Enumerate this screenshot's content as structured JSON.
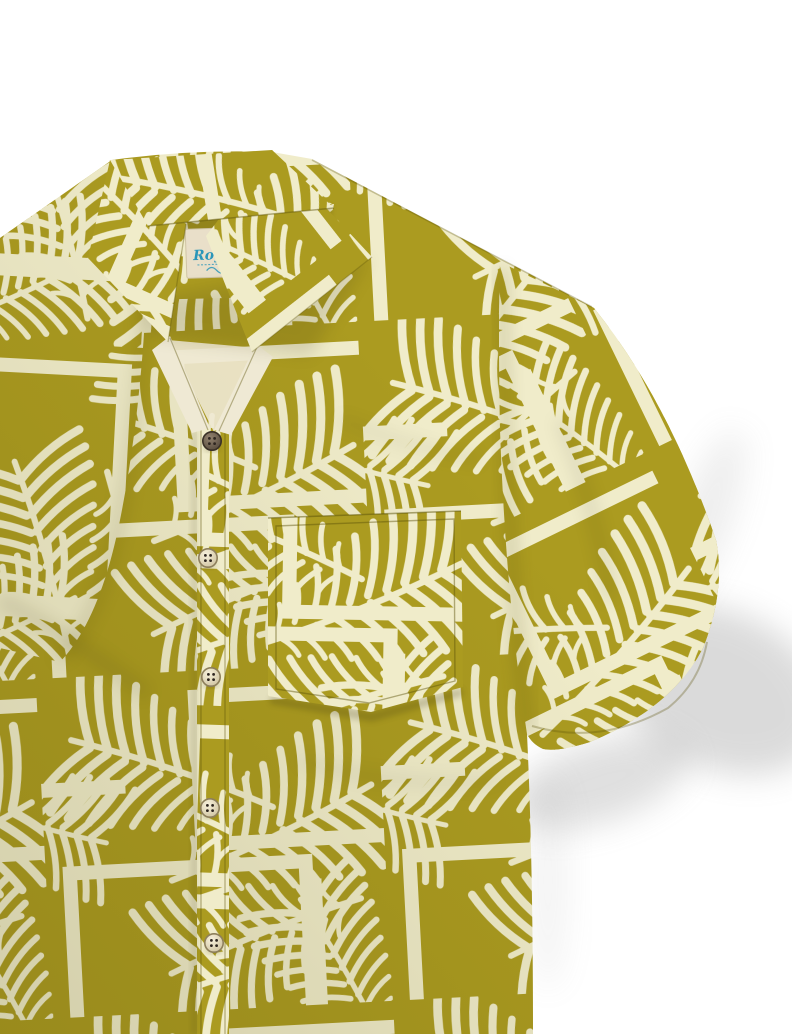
{
  "neck_label": {
    "brand": "Royaura",
    "icon": "palm-trees-icon"
  },
  "shirt": {
    "button_count": "5",
    "pattern": "palm-fronds-and-geometric-frames"
  },
  "palette": {
    "background": "#ffffff",
    "olive": "#ab9b20",
    "olive_dark": "#6f650e",
    "cream": "#f0ecca",
    "cream_soft": "#efe9d4",
    "seam": "#5a5108",
    "shadow": "#8f8f8f",
    "label_bg": "#e9dfc9",
    "label_ink": "#2a96b9",
    "button_face": "#efe6cc",
    "button_face_dark": "#7c6c5a",
    "button_ring": "#8d7f5c",
    "button_hole": "#2e2620"
  }
}
